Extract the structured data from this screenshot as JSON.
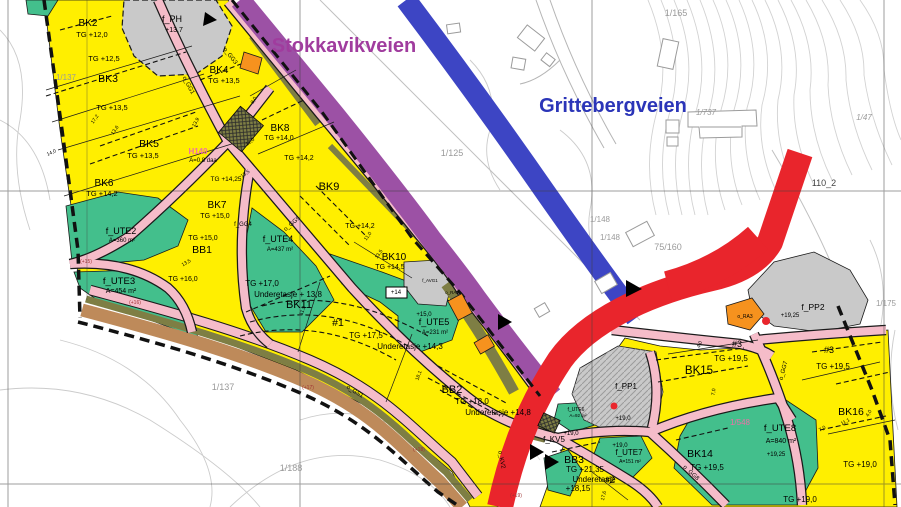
{
  "map": {
    "title": "Reguleringsplan (zoning plan) excerpt",
    "road_names": {
      "stokkavikveien": "Stokkavikveien",
      "grittebergveien": "Grittebergveien"
    },
    "colors": {
      "zone_yellow": "#ffef00",
      "zone_green": "#43bf8c",
      "zone_gray": "#c9c9c9",
      "zone_orange": "#f6921e",
      "road_purple": "#9c51a5",
      "road_blue": "#3d45c4",
      "road_red": "#e9252c",
      "road_pink": "#f5bcc9",
      "verge_olive": "#7e7e44",
      "path_brown": "#be8a5a",
      "label_purple": "#a03c9e",
      "label_blue": "#2b35b8",
      "label_pink": "#ef6fa8",
      "cadastral_gray": "#9a9a9a",
      "elevation_red": "#a03434"
    },
    "labels": [
      {
        "t": "BK2",
        "x": 88,
        "y": 26,
        "s": 10
      },
      {
        "t": "TG +12,0",
        "x": 92,
        "y": 37,
        "s": 7.5
      },
      {
        "t": "TG +12,5",
        "x": 104,
        "y": 61,
        "s": 7.5
      },
      {
        "t": "BK3",
        "x": 108,
        "y": 82,
        "s": 10.5
      },
      {
        "t": "TG +13,5",
        "x": 112,
        "y": 110,
        "s": 7.5
      },
      {
        "t": "BK5",
        "x": 149,
        "y": 147,
        "s": 10.5
      },
      {
        "t": "TG +13,5",
        "x": 143,
        "y": 158,
        "s": 7.5
      },
      {
        "t": "BK6",
        "x": 104,
        "y": 186,
        "s": 10
      },
      {
        "t": "TG +14,2",
        "x": 102,
        "y": 196,
        "s": 7.5
      },
      {
        "t": "f_PH",
        "x": 172,
        "y": 22,
        "s": 9
      },
      {
        "t": "+13,7",
        "x": 174,
        "y": 32,
        "s": 7
      },
      {
        "t": "BK4",
        "x": 219,
        "y": 73,
        "s": 10
      },
      {
        "t": "TG +13,5",
        "x": 224,
        "y": 83,
        "s": 7.5
      },
      {
        "t": "BK8",
        "x": 280,
        "y": 131,
        "s": 10
      },
      {
        "t": "TG +14,0",
        "x": 279,
        "y": 140,
        "s": 7
      },
      {
        "t": "TG +14,2",
        "x": 299,
        "y": 160,
        "s": 7
      },
      {
        "t": "BK9",
        "x": 329,
        "y": 190,
        "s": 11
      },
      {
        "t": "TG +14,2",
        "x": 360,
        "y": 228,
        "s": 7
      },
      {
        "t": "BK10",
        "x": 394,
        "y": 260,
        "s": 10
      },
      {
        "t": "TG +14,5",
        "x": 390,
        "y": 269,
        "s": 7
      },
      {
        "t": "BK7",
        "x": 217,
        "y": 208,
        "s": 10
      },
      {
        "t": "TG +15,0",
        "x": 215,
        "y": 218,
        "s": 7
      },
      {
        "t": "H140",
        "x": 198,
        "y": 154,
        "s": 8,
        "c": "#ef6fa8",
        "b": 1
      },
      {
        "t": "A=0,8 daa",
        "x": 203,
        "y": 162,
        "s": 6
      },
      {
        "t": "TG +14,25",
        "x": 226,
        "y": 181,
        "s": 6.5
      },
      {
        "t": "f_UTE2",
        "x": 121,
        "y": 234,
        "s": 9
      },
      {
        "t": "A=360 m²",
        "x": 122,
        "y": 242,
        "s": 6
      },
      {
        "t": "TG +15,0",
        "x": 203,
        "y": 240,
        "s": 7
      },
      {
        "t": "BB1",
        "x": 202,
        "y": 253,
        "s": 10.5
      },
      {
        "t": "TG +16,0",
        "x": 183,
        "y": 281,
        "s": 7
      },
      {
        "t": "f_UTE3",
        "x": 119,
        "y": 284,
        "s": 9.5
      },
      {
        "t": "A=454 m²",
        "x": 121,
        "y": 293,
        "s": 7
      },
      {
        "t": "f_UTE4",
        "x": 278,
        "y": 242,
        "s": 9
      },
      {
        "t": "A=437 m²",
        "x": 280,
        "y": 251,
        "s": 6
      },
      {
        "t": "o_GG5",
        "x": 293,
        "y": 225,
        "s": 6,
        "r": -40
      },
      {
        "t": "1/125",
        "x": 452,
        "y": 156,
        "s": 9,
        "c": "#9a9a9a"
      },
      {
        "t": "TG +17,0",
        "x": 262,
        "y": 286,
        "s": 8
      },
      {
        "t": "Underetasje + 13,8",
        "x": 288,
        "y": 297,
        "s": 8
      },
      {
        "t": "BK11",
        "x": 299,
        "y": 308,
        "s": 11
      },
      {
        "t": "#1",
        "x": 338,
        "y": 326,
        "s": 10.5
      },
      {
        "t": "TG +17,5",
        "x": 366,
        "y": 338,
        "s": 8
      },
      {
        "t": "Underetasje +14,3",
        "x": 410,
        "y": 349,
        "s": 8
      },
      {
        "t": "+15,0",
        "x": 424,
        "y": 316,
        "s": 6
      },
      {
        "t": "f_UTE5",
        "x": 434,
        "y": 325,
        "s": 9
      },
      {
        "t": "A=231 m²",
        "x": 435,
        "y": 334,
        "s": 6
      },
      {
        "t": "BB2",
        "x": 452,
        "y": 393,
        "s": 11
      },
      {
        "t": "TG +18,0",
        "x": 472,
        "y": 404,
        "s": 8
      },
      {
        "t": "Underetasje +14,8",
        "x": 498,
        "y": 415,
        "s": 8
      },
      {
        "t": "o_GS1",
        "x": 354,
        "y": 393,
        "s": 6,
        "r": 32
      },
      {
        "t": "(+15)",
        "x": 86,
        "y": 263,
        "s": 5,
        "c": "#a03434"
      },
      {
        "t": "(+16)",
        "x": 135,
        "y": 304,
        "s": 5,
        "c": "#a03434"
      },
      {
        "t": "(+17)",
        "x": 308,
        "y": 389,
        "s": 5,
        "c": "#a03434"
      },
      {
        "t": "(+18)",
        "x": 419,
        "y": 451,
        "s": 5,
        "c": "#a03434"
      },
      {
        "t": "(+19)",
        "x": 516,
        "y": 497,
        "s": 5,
        "c": "#a03434"
      },
      {
        "t": "1/137",
        "x": 66,
        "y": 80,
        "s": 8,
        "c": "#9a9a9a"
      },
      {
        "t": "1/137",
        "x": 223,
        "y": 390,
        "s": 9,
        "c": "#9a9a9a"
      },
      {
        "t": "1/188",
        "x": 291,
        "y": 471,
        "s": 9,
        "c": "#9a9a9a"
      },
      {
        "t": "1/165",
        "x": 676,
        "y": 16,
        "s": 9,
        "c": "#9a9a9a"
      },
      {
        "t": "1/737",
        "x": 706,
        "y": 115,
        "s": 8,
        "c": "#9a9a9a",
        "i": 1
      },
      {
        "t": "1/47",
        "x": 864,
        "y": 120,
        "s": 8,
        "c": "#9a9a9a",
        "i": 1
      },
      {
        "t": "110_2",
        "x": 824,
        "y": 186,
        "s": 9,
        "c": "#444444"
      },
      {
        "t": "1/148",
        "x": 600,
        "y": 222,
        "s": 8,
        "c": "#9a9a9a"
      },
      {
        "t": "1/148",
        "x": 610,
        "y": 240,
        "s": 8,
        "c": "#9a9a9a"
      },
      {
        "t": "75/160",
        "x": 668,
        "y": 250,
        "s": 9,
        "c": "#9a9a9a"
      },
      {
        "t": "1/175",
        "x": 886,
        "y": 306,
        "s": 8,
        "c": "#9a9a9a"
      },
      {
        "t": "f_PP1",
        "x": 626,
        "y": 389,
        "s": 8
      },
      {
        "t": "+19,0",
        "x": 623,
        "y": 420,
        "s": 6
      },
      {
        "t": "f_UTE6",
        "x": 576,
        "y": 411,
        "s": 5
      },
      {
        "t": "A=92 m²",
        "x": 578,
        "y": 417,
        "s": 4.5
      },
      {
        "t": "+19,0",
        "x": 571,
        "y": 435,
        "s": 6
      },
      {
        "t": "+19,0",
        "x": 620,
        "y": 447,
        "s": 6
      },
      {
        "t": "f_KV5",
        "x": 554,
        "y": 442,
        "s": 8
      },
      {
        "t": "BB3",
        "x": 574,
        "y": 463,
        "s": 10.5
      },
      {
        "t": "TG +21,35",
        "x": 585,
        "y": 472,
        "s": 8
      },
      {
        "t": "Underetasje",
        "x": 594,
        "y": 482,
        "s": 8
      },
      {
        "t": "+18,15",
        "x": 578,
        "y": 491,
        "s": 8
      },
      {
        "t": "#2",
        "x": 610,
        "y": 483,
        "s": 9
      },
      {
        "t": "f_UTE7",
        "x": 629,
        "y": 455,
        "s": 8
      },
      {
        "t": "A=151 m²",
        "x": 630,
        "y": 463,
        "s": 5
      },
      {
        "t": "BK14",
        "x": 700,
        "y": 457,
        "s": 10.5
      },
      {
        "t": "TG +19,5",
        "x": 707,
        "y": 470,
        "s": 8
      },
      {
        "t": "o_RA3",
        "x": 745,
        "y": 318,
        "s": 5
      },
      {
        "t": "f_PP2",
        "x": 813,
        "y": 310,
        "s": 8.5
      },
      {
        "t": "+19,25",
        "x": 790,
        "y": 317,
        "s": 6
      },
      {
        "t": "#3",
        "x": 737,
        "y": 347,
        "s": 9
      },
      {
        "t": "TG +19,5",
        "x": 731,
        "y": 361,
        "s": 8
      },
      {
        "t": "BK15",
        "x": 699,
        "y": 374,
        "s": 11.5
      },
      {
        "t": "#3",
        "x": 829,
        "y": 353,
        "s": 9
      },
      {
        "t": "TG +19,5",
        "x": 833,
        "y": 369,
        "s": 8
      },
      {
        "t": "BK16",
        "x": 851,
        "y": 415,
        "s": 10.5
      },
      {
        "t": "TG +19,0",
        "x": 860,
        "y": 467,
        "s": 8
      },
      {
        "t": "TG +19,0",
        "x": 800,
        "y": 502,
        "s": 8
      },
      {
        "t": "1/548",
        "x": 740,
        "y": 425,
        "s": 8,
        "c": "#ef6fa8"
      },
      {
        "t": "f_UTE8",
        "x": 780,
        "y": 431,
        "s": 9.5
      },
      {
        "t": "A=840 m²",
        "x": 781,
        "y": 443,
        "s": 7
      },
      {
        "t": "+19,25",
        "x": 776,
        "y": 456,
        "s": 6
      },
      {
        "t": "o_GG7",
        "x": 785,
        "y": 371,
        "s": 6,
        "r": -75
      },
      {
        "t": "o_GG8",
        "x": 690,
        "y": 474,
        "s": 6,
        "r": 42
      },
      {
        "t": "o_GG1",
        "x": 187,
        "y": 86,
        "s": 6,
        "r": 62
      },
      {
        "t": "o_GG3",
        "x": 229,
        "y": 57,
        "s": 6,
        "r": 52
      },
      {
        "t": "f_GG4",
        "x": 243,
        "y": 226,
        "s": 6
      },
      {
        "t": "o_KV2",
        "x": 500,
        "y": 460,
        "s": 6,
        "r": 78
      },
      {
        "t": "+14",
        "x": 396,
        "y": 294,
        "s": 6
      },
      {
        "t": "o_RA2",
        "x": 452,
        "y": 294,
        "s": 4.5
      },
      {
        "t": "f_AVG1",
        "x": 430,
        "y": 282,
        "s": 4.5
      },
      {
        "t": "17,2",
        "x": 96,
        "y": 120,
        "s": 5,
        "r": -55
      },
      {
        "t": "13,6",
        "x": 116,
        "y": 131,
        "s": 5,
        "r": -55
      },
      {
        "t": "14,0",
        "x": 52,
        "y": 154,
        "s": 5,
        "r": -25
      },
      {
        "t": "13,9",
        "x": 197,
        "y": 123,
        "s": 5,
        "r": -60
      },
      {
        "t": "8,0",
        "x": 255,
        "y": 101,
        "s": 5,
        "r": -60
      },
      {
        "t": "12,0",
        "x": 251,
        "y": 143,
        "s": 5,
        "r": -38
      },
      {
        "t": "11,0",
        "x": 369,
        "y": 237,
        "s": 5,
        "r": -55
      },
      {
        "t": "13,5",
        "x": 380,
        "y": 255,
        "s": 5,
        "r": -55
      },
      {
        "t": "11,9",
        "x": 304,
        "y": 311,
        "s": 5,
        "r": -70
      },
      {
        "t": "13,5",
        "x": 246,
        "y": 175,
        "s": 5,
        "r": -35
      },
      {
        "t": "13,5",
        "x": 187,
        "y": 264,
        "s": 5,
        "r": -30
      },
      {
        "t": "18,1",
        "x": 420,
        "y": 376,
        "s": 5,
        "r": -70
      },
      {
        "t": "17,6",
        "x": 605,
        "y": 496,
        "s": 5,
        "r": -76
      },
      {
        "t": "7,0",
        "x": 715,
        "y": 392,
        "s": 5,
        "r": -84
      },
      {
        "t": "7,0",
        "x": 823,
        "y": 430,
        "s": 5,
        "r": -30
      },
      {
        "t": "11,1",
        "x": 846,
        "y": 423,
        "s": 5,
        "r": -28
      },
      {
        "t": "4,0",
        "x": 870,
        "y": 414,
        "s": 5,
        "r": -60
      },
      {
        "t": "4,0",
        "x": 701,
        "y": 345,
        "s": 5,
        "r": -70
      }
    ]
  }
}
